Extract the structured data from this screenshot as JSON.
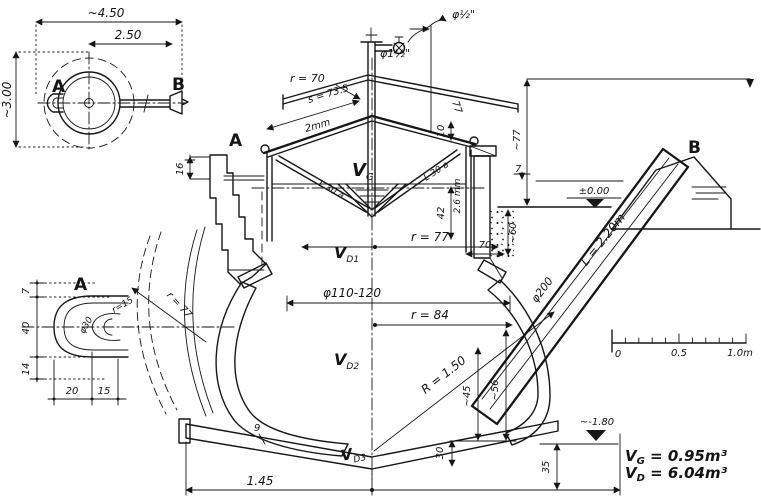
{
  "plan": {
    "dim_width": "~4.50",
    "dim_offset": "2.50",
    "dim_depth": "~3.00",
    "port_a": "A",
    "port_b": "B"
  },
  "gas_unit": {
    "valve_dia": "φ½\"",
    "pipe_dia": "φ1½\"",
    "roof_radius": "r = 70",
    "roof_slant": "s = 73.5",
    "sheet_thickness": "2mm",
    "slope_len": "77",
    "rim_height": "10",
    "drum_height": "42",
    "wall_thickness": "2.6 mm",
    "drum_radius": "r = 77",
    "strut_left": "L 30 a",
    "strut_right": "L 30 a"
  },
  "section": {
    "wall_label": "A",
    "wall_top_dim": "16",
    "height_above": "~77",
    "freeboard": "7",
    "level_zero": "±0.00",
    "inlet_label": "B",
    "inlet_pipe_dia": "φ200",
    "inlet_pipe_len": "L = 2.20m",
    "pocket_width": "70",
    "pocket_depth": "~60",
    "opening_dia": "φ110-120",
    "radius_mid": "r = 84",
    "radius_shell": "R = 1.50",
    "dim_45": "~45",
    "dim_56": "~56",
    "dim_30": "30",
    "dim_35": "35",
    "base_width": "1.45",
    "floor_thickness": "9",
    "level_bottom": "~-1.80"
  },
  "volume_labels": {
    "v": "V",
    "sub_g": "G",
    "sub_d1": "D1",
    "sub_d2": "D2",
    "sub_d3": "D3"
  },
  "detail_a": {
    "label": "A",
    "wall_radius": "r = 77",
    "mouth_radius": "r=15",
    "mouth_dia": "φ30",
    "dim_7": "7",
    "dim_40": "40",
    "dim_14": "14",
    "dim_20": "20",
    "dim_15": "15"
  },
  "scale_bar": {
    "t0": "0",
    "t_half": "0.5",
    "t_one": "1.0m"
  },
  "results": {
    "vg_v": "V",
    "vg_sub": "G",
    "vg_val": " = 0.95m³",
    "vd_v": "V",
    "vd_sub": "D",
    "vd_val": " = 6.04m³"
  }
}
